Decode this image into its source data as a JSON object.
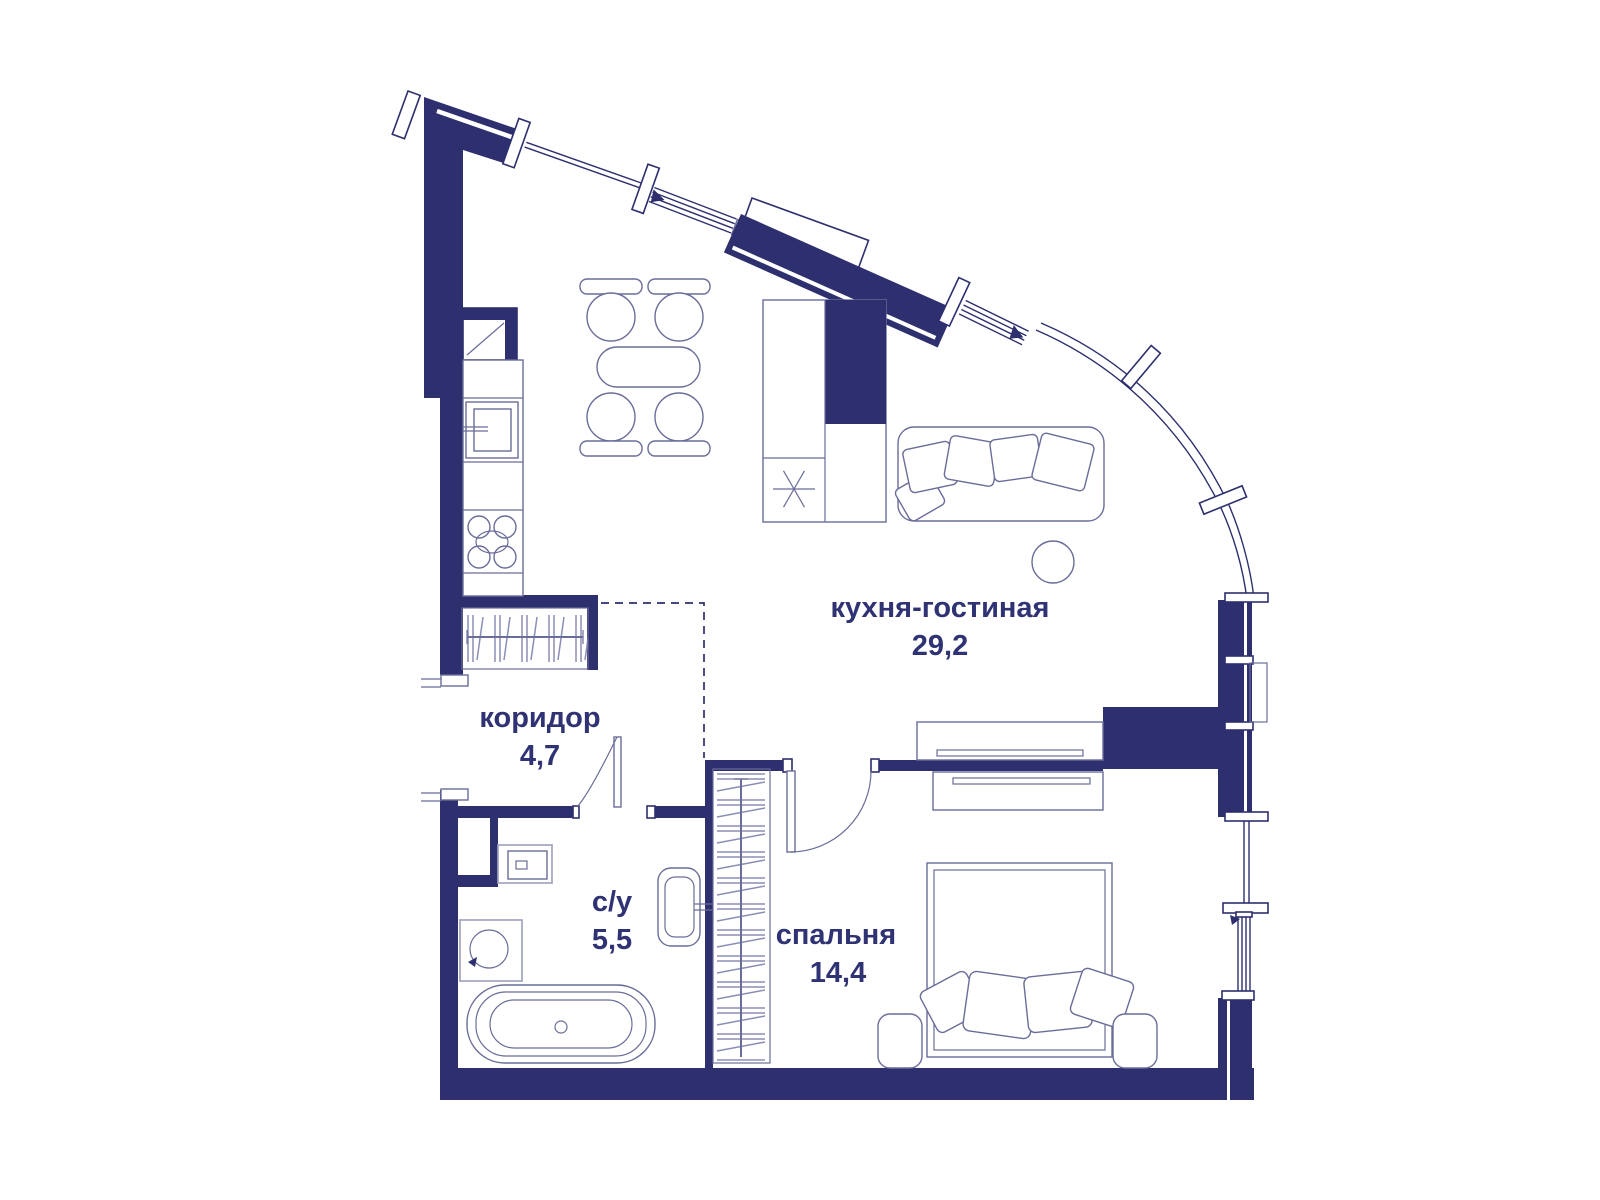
{
  "plan": {
    "type": "apartment-floor-plan",
    "rooms": [
      {
        "id": "kitchen-living",
        "name": "кухня-гостиная",
        "area": "29,2"
      },
      {
        "id": "corridor",
        "name": "коридор",
        "area": "4,7"
      },
      {
        "id": "bathroom",
        "name": "с/у",
        "area": "5,5"
      },
      {
        "id": "bedroom",
        "name": "спальня",
        "area": "14,4"
      }
    ],
    "colors": {
      "wall": "#2d2f6e",
      "furniture": "#6a6d99",
      "hatch": "#8b8eb6",
      "muted": "#a2a4c0",
      "text": "#2f3273"
    }
  }
}
